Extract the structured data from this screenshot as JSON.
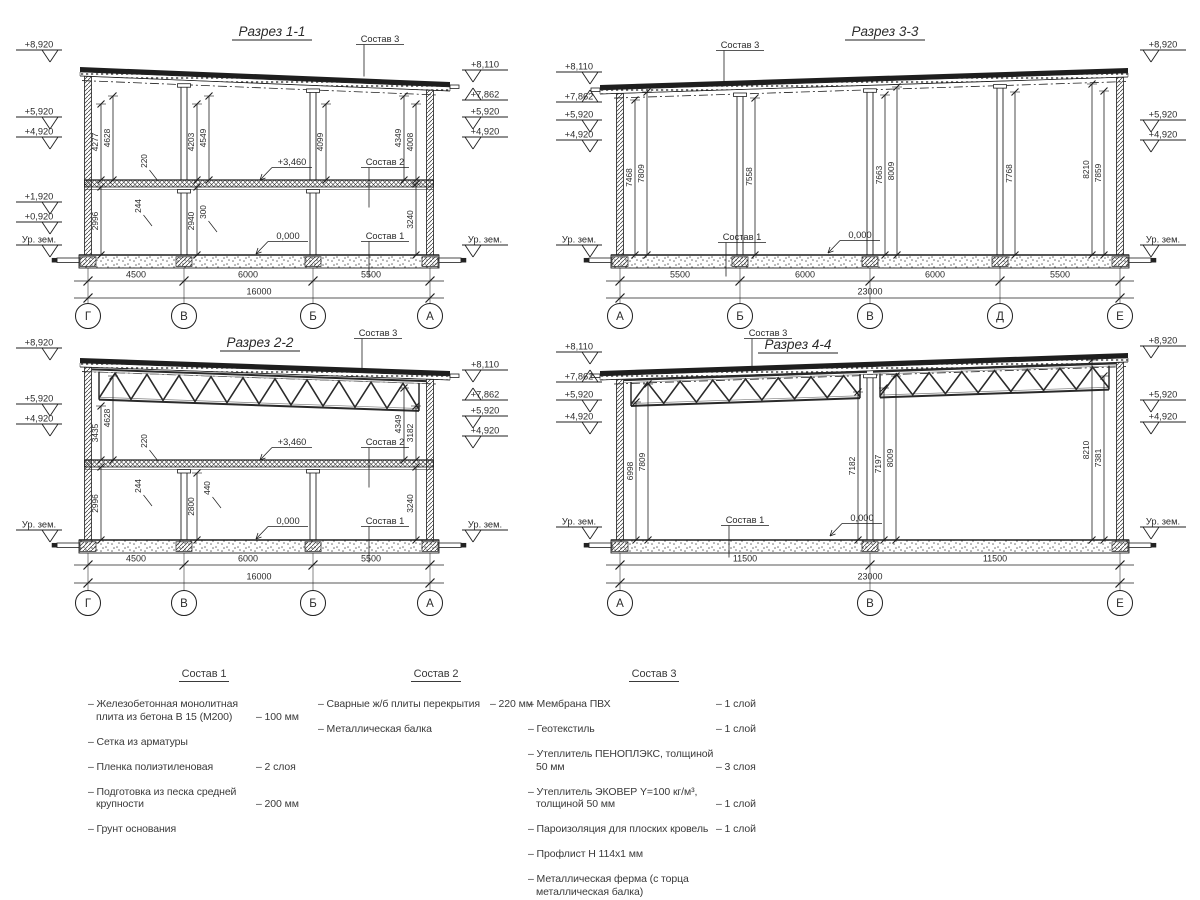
{
  "sheet": {
    "width": 1200,
    "height": 900,
    "bg": "#ffffff",
    "ink": "#1f1f1f"
  },
  "sections": [
    {
      "name": "1-1",
      "title": "Разрез 1-1",
      "totalDim": "16000",
      "frame": {
        "x": 0,
        "y": 0,
        "w": 540,
        "h": 340
      },
      "geom": {
        "titleX": 272,
        "titleY": 36,
        "wallL": 88,
        "wallR": 430,
        "roofYL": 67,
        "roofYR": 82,
        "eaves": "right",
        "floorY": 180,
        "groundY": 255,
        "dimY1": 281,
        "dimY2": 298,
        "bubbleY": 316,
        "markLX": 16,
        "markRX": 462,
        "upperColumns": [
          184,
          313
        ],
        "lowerColumns": [
          184,
          313
        ],
        "fullColumns": [],
        "trussSpans": [],
        "trussDepth": 0,
        "trussTopOff": 0
      },
      "axes": [
        {
          "label": "Г",
          "x": 88
        },
        {
          "label": "В",
          "x": 184
        },
        {
          "label": "Б",
          "x": 313
        },
        {
          "label": "А",
          "x": 430
        }
      ],
      "bottomDims": [
        {
          "label": "4500",
          "cx": 136
        },
        {
          "label": "6000",
          "cx": 248
        },
        {
          "label": "5500",
          "cx": 371
        }
      ],
      "leftMarks": [
        {
          "label": "+8,920",
          "y": 50
        },
        {
          "label": "+5,920",
          "y": 117
        },
        {
          "label": "+4,920",
          "y": 137
        },
        {
          "label": "+1,920",
          "y": 202
        },
        {
          "label": "+0,920",
          "y": 222
        },
        {
          "label": "Ур. зем.",
          "y": 245
        }
      ],
      "rightMarks": [
        {
          "label": "+8,110",
          "y": 70
        },
        {
          "label": "+7,862",
          "y": 100,
          "up": true
        },
        {
          "label": "+5,920",
          "y": 117
        },
        {
          "label": "+4,920",
          "y": 137
        },
        {
          "label": "Ур. зем.",
          "y": 245
        }
      ],
      "vDims": [
        {
          "label": "4277",
          "x": 101,
          "y1": 104,
          "y2": 180
        },
        {
          "label": "4628",
          "x": 113,
          "y1": 96,
          "y2": 180
        },
        {
          "label": "4203",
          "x": 197,
          "y1": 104,
          "y2": 180
        },
        {
          "label": "4549",
          "x": 209,
          "y1": 96,
          "y2": 180
        },
        {
          "label": "4099",
          "x": 326,
          "y1": 104,
          "y2": 180
        },
        {
          "label": "4349",
          "x": 404,
          "y1": 96,
          "y2": 180
        },
        {
          "label": "4008",
          "x": 416,
          "y1": 104,
          "y2": 180
        },
        {
          "label": "2996",
          "x": 101,
          "y1": 187,
          "y2": 255
        },
        {
          "label": "2940",
          "x": 197,
          "y1": 187,
          "y2": 255
        },
        {
          "label": "3240",
          "x": 416,
          "y1": 184,
          "y2": 255
        }
      ],
      "callouts": [
        {
          "label": "220",
          "x": 147,
          "y": 161
        },
        {
          "label": "244",
          "x": 141,
          "y": 206
        },
        {
          "label": "300",
          "x": 206,
          "y": 212
        }
      ],
      "notes": [
        {
          "label": "Состав 3",
          "x": 380,
          "y": 42,
          "type": "leader",
          "len": 32
        },
        {
          "label": "+3,460",
          "x": 292,
          "y": 165,
          "type": "arrow"
        },
        {
          "label": "Состав 2",
          "x": 385,
          "y": 165,
          "type": "leader",
          "len": 40
        },
        {
          "label": "0,000",
          "x": 288,
          "y": 239,
          "type": "arrow"
        },
        {
          "label": "Состав 1",
          "x": 385,
          "y": 239,
          "type": "leader",
          "len": 36
        }
      ]
    },
    {
      "name": "3-3",
      "title": "Разрез 3-3",
      "totalDim": "23000",
      "frame": {
        "x": 540,
        "y": 0,
        "w": 660,
        "h": 340
      },
      "geom": {
        "titleX": 345,
        "titleY": 36,
        "wallL": 80,
        "wallR": 580,
        "roofYL": 85,
        "roofYR": 68,
        "eaves": "left",
        "floorY": null,
        "groundY": 255,
        "dimY1": 281,
        "dimY2": 298,
        "bubbleY": 316,
        "markLX": 16,
        "markRX": 600,
        "upperColumns": [],
        "lowerColumns": [],
        "fullColumns": [
          200,
          330,
          460
        ],
        "trussSpans": [],
        "trussDepth": 0,
        "trussTopOff": 0
      },
      "axes": [
        {
          "label": "А",
          "x": 80
        },
        {
          "label": "Б",
          "x": 200
        },
        {
          "label": "В",
          "x": 330
        },
        {
          "label": "Д",
          "x": 460
        },
        {
          "label": "Е",
          "x": 580
        }
      ],
      "bottomDims": [
        {
          "label": "5500",
          "cx": 140
        },
        {
          "label": "6000",
          "cx": 265
        },
        {
          "label": "6000",
          "cx": 395
        },
        {
          "label": "5500",
          "cx": 520
        }
      ],
      "leftMarks": [
        {
          "label": "+8,110",
          "y": 72
        },
        {
          "label": "+7,862",
          "y": 102,
          "up": true
        },
        {
          "label": "+5,920",
          "y": 120
        },
        {
          "label": "+4,920",
          "y": 140
        },
        {
          "label": "Ур. зем.",
          "y": 245
        }
      ],
      "rightMarks": [
        {
          "label": "+8,920",
          "y": 50
        },
        {
          "label": "+5,920",
          "y": 120
        },
        {
          "label": "+4,920",
          "y": 140
        },
        {
          "label": "Ур. зем.",
          "y": 245
        }
      ],
      "vDims": [
        {
          "label": "7468",
          "x": 95,
          "y1": 100,
          "y2": 255
        },
        {
          "label": "7809",
          "x": 107,
          "y1": 92,
          "y2": 255
        },
        {
          "label": "7558",
          "x": 215,
          "y1": 98,
          "y2": 255
        },
        {
          "label": "7663",
          "x": 345,
          "y1": 95,
          "y2": 255
        },
        {
          "label": "8009",
          "x": 357,
          "y1": 87,
          "y2": 255
        },
        {
          "label": "7768",
          "x": 475,
          "y1": 92,
          "y2": 255
        },
        {
          "label": "8210",
          "x": 552,
          "y1": 84,
          "y2": 255
        },
        {
          "label": "7859",
          "x": 564,
          "y1": 91,
          "y2": 255
        }
      ],
      "callouts": [],
      "notes": [
        {
          "label": "Состав 3",
          "x": 200,
          "y": 48,
          "type": "leader",
          "len": 36
        },
        {
          "label": "Состав 1",
          "x": 202,
          "y": 240,
          "type": "leader",
          "len": 34
        },
        {
          "label": "0,000",
          "x": 320,
          "y": 238,
          "type": "arrow"
        }
      ]
    },
    {
      "name": "2-2",
      "title": "Разрез 2-2",
      "totalDim": "16000",
      "frame": {
        "x": 0,
        "y": 318,
        "w": 540,
        "h": 330
      },
      "geom": {
        "titleX": 260,
        "titleY": 29,
        "wallL": 88,
        "wallR": 430,
        "roofYL": 40,
        "roofYR": 53,
        "eaves": "right",
        "floorY": 142,
        "groundY": 222,
        "dimY1": 247,
        "dimY2": 265,
        "bubbleY": 285,
        "markLX": 16,
        "markRX": 462,
        "upperColumns": [],
        "lowerColumns": [
          184,
          313
        ],
        "fullColumns": [],
        "trussSpans": [
          [
            92,
            426
          ]
        ],
        "trussDepth": 30,
        "trussTopOff": 11
      },
      "axes": [
        {
          "label": "Г",
          "x": 88
        },
        {
          "label": "В",
          "x": 184
        },
        {
          "label": "Б",
          "x": 313
        },
        {
          "label": "А",
          "x": 430
        }
      ],
      "bottomDims": [
        {
          "label": "4500",
          "cx": 136
        },
        {
          "label": "6000",
          "cx": 248
        },
        {
          "label": "5500",
          "cx": 371
        }
      ],
      "leftMarks": [
        {
          "label": "+8,920",
          "y": 30
        },
        {
          "label": "+5,920",
          "y": 86
        },
        {
          "label": "+4,920",
          "y": 106
        },
        {
          "label": "Ур. зем.",
          "y": 212
        }
      ],
      "rightMarks": [
        {
          "label": "+8,110",
          "y": 52
        },
        {
          "label": "+7,862",
          "y": 82,
          "up": true
        },
        {
          "label": "+5,920",
          "y": 98
        },
        {
          "label": "+4,920",
          "y": 118
        },
        {
          "label": "Ур. зем.",
          "y": 212
        }
      ],
      "vDims": [
        {
          "label": "3435",
          "x": 101,
          "y1": 88,
          "y2": 142
        },
        {
          "label": "4628",
          "x": 113,
          "y1": 58,
          "y2": 142
        },
        {
          "label": "2996",
          "x": 101,
          "y1": 149,
          "y2": 222
        },
        {
          "label": "2800",
          "x": 197,
          "y1": 155,
          "y2": 222
        },
        {
          "label": "4349",
          "x": 404,
          "y1": 70,
          "y2": 142
        },
        {
          "label": "3182",
          "x": 416,
          "y1": 88,
          "y2": 142
        },
        {
          "label": "3240",
          "x": 416,
          "y1": 149,
          "y2": 222
        }
      ],
      "callouts": [
        {
          "label": "220",
          "x": 147,
          "y": 123
        },
        {
          "label": "244",
          "x": 141,
          "y": 168
        },
        {
          "label": "440",
          "x": 210,
          "y": 170
        }
      ],
      "notes": [
        {
          "label": "Состав 3",
          "x": 378,
          "y": 18,
          "type": "leader",
          "len": 30
        },
        {
          "label": "+3,460",
          "x": 292,
          "y": 127,
          "type": "arrow"
        },
        {
          "label": "Состав 2",
          "x": 385,
          "y": 127,
          "type": "leader",
          "len": 40
        },
        {
          "label": "0,000",
          "x": 288,
          "y": 206,
          "type": "arrow"
        },
        {
          "label": "Состав 1",
          "x": 385,
          "y": 206,
          "type": "leader",
          "len": 36
        }
      ]
    },
    {
      "name": "4-4",
      "title": "Разрез 4-4",
      "totalDim": "23000",
      "frame": {
        "x": 540,
        "y": 318,
        "w": 660,
        "h": 330
      },
      "geom": {
        "titleX": 258,
        "titleY": 31,
        "wallL": 80,
        "wallR": 580,
        "roofYL": 53,
        "roofYR": 35,
        "eaves": "left",
        "floorY": null,
        "groundY": 222,
        "dimY1": 247,
        "dimY2": 265,
        "bubbleY": 285,
        "markLX": 16,
        "markRX": 600,
        "upperColumns": [],
        "lowerColumns": [],
        "fullColumns": [
          330
        ],
        "trussSpans": [
          [
            84,
            327
          ],
          [
            333,
            576
          ]
        ],
        "trussDepth": 26,
        "trussTopOff": 10
      },
      "axes": [
        {
          "label": "А",
          "x": 80
        },
        {
          "label": "В",
          "x": 330
        },
        {
          "label": "Е",
          "x": 580
        }
      ],
      "bottomDims": [
        {
          "label": "11500",
          "cx": 205
        },
        {
          "label": "11500",
          "cx": 455
        }
      ],
      "leftMarks": [
        {
          "label": "+8,110",
          "y": 34
        },
        {
          "label": "+7,862",
          "y": 64,
          "up": true
        },
        {
          "label": "+5,920",
          "y": 82
        },
        {
          "label": "+4,920",
          "y": 104
        },
        {
          "label": "Ур. зем.",
          "y": 209
        }
      ],
      "rightMarks": [
        {
          "label": "+8,920",
          "y": 28
        },
        {
          "label": "+5,920",
          "y": 82
        },
        {
          "label": "+4,920",
          "y": 104
        },
        {
          "label": "Ур. зем.",
          "y": 209
        }
      ],
      "vDims": [
        {
          "label": "6998",
          "x": 96,
          "y1": 84,
          "y2": 222
        },
        {
          "label": "7809",
          "x": 108,
          "y1": 66,
          "y2": 222
        },
        {
          "label": "7182",
          "x": 318,
          "y1": 74,
          "y2": 222
        },
        {
          "label": "7197",
          "x": 344,
          "y1": 70,
          "y2": 222
        },
        {
          "label": "8009",
          "x": 356,
          "y1": 58,
          "y2": 222
        },
        {
          "label": "8210",
          "x": 552,
          "y1": 42,
          "y2": 222
        },
        {
          "label": "7381",
          "x": 564,
          "y1": 58,
          "y2": 222
        }
      ],
      "callouts": [],
      "notes": [
        {
          "label": "Состав 3",
          "x": 228,
          "y": 18,
          "type": "leader",
          "len": 34
        },
        {
          "label": "Состав 1",
          "x": 205,
          "y": 205,
          "type": "leader",
          "len": 32
        },
        {
          "label": "0,000",
          "x": 322,
          "y": 203,
          "type": "arrow"
        }
      ]
    }
  ],
  "legend": {
    "columns": [
      {
        "header": "Состав 1",
        "x": 88,
        "w": 232,
        "items": [
          {
            "text": "– Железобетонная  монолитная плита из бетона В 15 (М200)",
            "value": "– 100 мм"
          },
          {
            "text": "– Сетка из арматуры",
            "value": ""
          },
          {
            "text": "– Пленка полиэтиленовая",
            "value": "–  2 слоя"
          },
          {
            "text": "– Подготовка из песка средней крупности",
            "value": "– 200 мм"
          },
          {
            "text": "– Грунт основания",
            "value": ""
          }
        ]
      },
      {
        "header": "Состав 2",
        "x": 318,
        "w": 236,
        "items": [
          {
            "text": "– Сварные ж/б плиты перекрытия",
            "value": "– 220 мм"
          },
          {
            "text": "– Металлическая балка",
            "value": ""
          }
        ]
      },
      {
        "header": "Состав 3",
        "x": 528,
        "w": 252,
        "items": [
          {
            "text": "– Мембрана ПВХ",
            "value": "– 1 слой"
          },
          {
            "text": "– Геотекстиль",
            "value": "– 1 слой"
          },
          {
            "text": "– Утеплитель ПЕНОПЛЭКС, толщиной 50 мм",
            "value": "– 3 слоя"
          },
          {
            "text": "– Утеплитель ЭКОВЕР Y=100 кг/м³, толщиной 50 мм",
            "value": "– 1 слой"
          },
          {
            "text": "– Пароизоляция для плоских кровель",
            "value": "– 1 слой"
          },
          {
            "text": "– Профлист Н 114х1 мм",
            "value": ""
          },
          {
            "text": "– Металлическая ферма (с торца металлическая балка)",
            "value": ""
          }
        ]
      }
    ]
  }
}
